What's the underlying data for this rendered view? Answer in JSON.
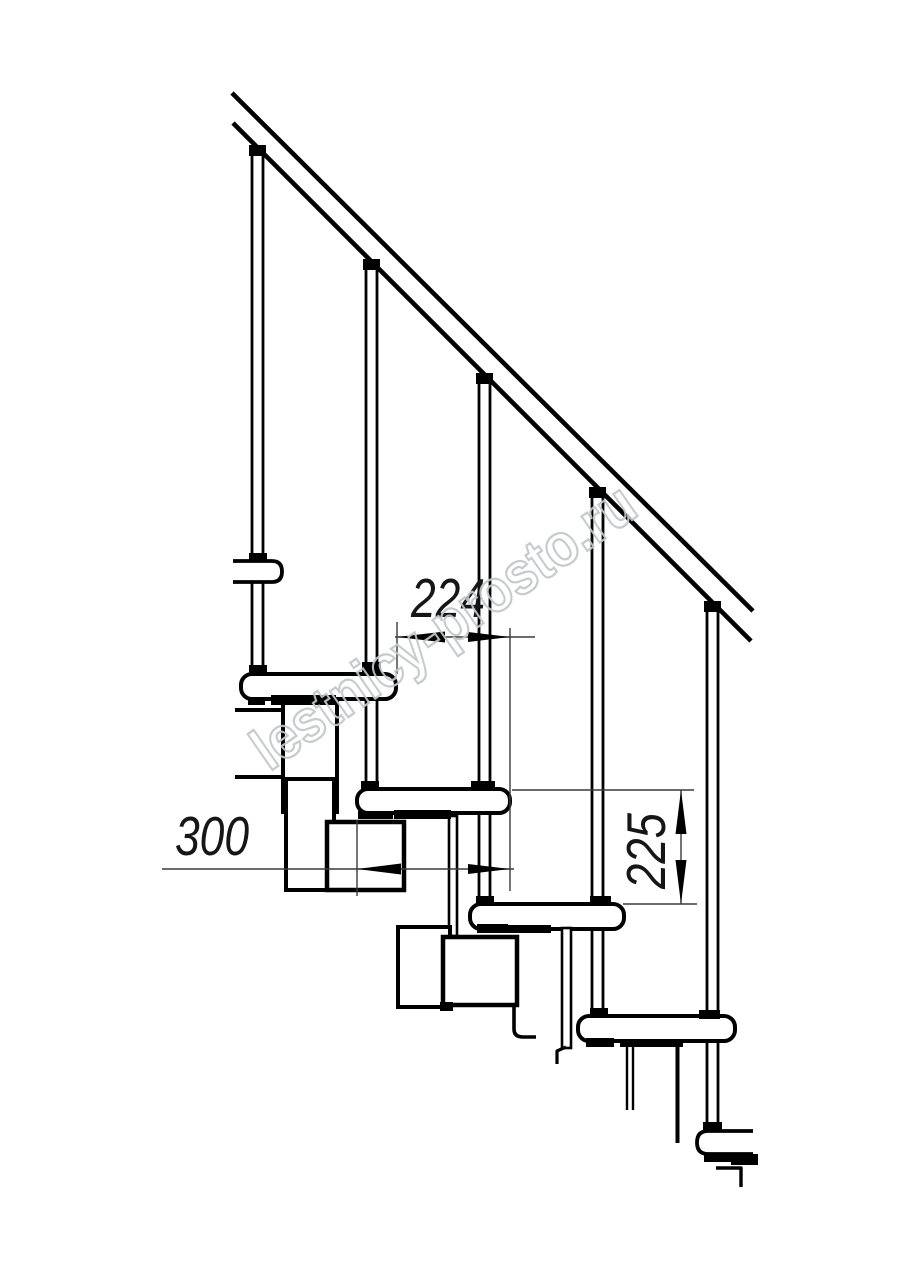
{
  "meta": {
    "canvas_width": 914,
    "canvas_height": 1280,
    "background_color": "#ffffff",
    "ink_color": "#000000",
    "dim_line_color": "#3a3a3a",
    "watermark_color": "#c2c7ca"
  },
  "labels": {
    "dim_run": "224",
    "dim_depth": "300",
    "dim_rise": "225",
    "watermark": "lestnicy-prosto.ru"
  },
  "diagram_data": {
    "type": "technical-drawing",
    "subject": "modular staircase side elevation with balusters and handrail",
    "dimensions_mm": {
      "step_run": 224,
      "tread_depth": 300,
      "step_rise": 225
    },
    "visible_counts": {
      "balusters": 5,
      "full_treads": 4,
      "cut_tread_stubs": 2
    },
    "scale_px_per_mm": 0.5
  },
  "shapes": [
    {
      "name": "baluster-1",
      "type": "baluster",
      "cx": 257.5,
      "y1": 150,
      "y2": 672
    },
    {
      "name": "baluster-2",
      "type": "baluster",
      "cx": 371.5,
      "y1": 264,
      "y2": 788
    },
    {
      "name": "baluster-3",
      "type": "baluster",
      "cx": 484.5,
      "y1": 378,
      "y2": 903
    },
    {
      "name": "baluster-4",
      "type": "baluster",
      "cx": 597.5,
      "y1": 492,
      "y2": 1015
    },
    {
      "name": "baluster-5",
      "type": "baluster",
      "cx": 712.5,
      "y1": 606,
      "y2": 1129
    },
    {
      "name": "handrail-upper-line",
      "type": "line",
      "x1": 232,
      "y1": 93,
      "x2": 753,
      "y2": 611,
      "sw": 4.6
    },
    {
      "name": "handrail-lower-line",
      "type": "line",
      "x1": 233,
      "y1": 123,
      "x2": 751,
      "y2": 641,
      "sw": 4.6
    },
    {
      "name": "rail-tab-1",
      "type": "blackrect",
      "x": 249,
      "y": 145,
      "w": 17,
      "h": 11
    },
    {
      "name": "rail-tab-2",
      "type": "blackrect",
      "x": 363,
      "y": 259,
      "w": 17,
      "h": 11
    },
    {
      "name": "rail-tab-3",
      "type": "blackrect",
      "x": 476,
      "y": 373,
      "w": 17,
      "h": 11
    },
    {
      "name": "rail-tab-4",
      "type": "blackrect",
      "x": 589,
      "y": 487,
      "w": 17,
      "h": 11
    },
    {
      "name": "rail-tab-5",
      "type": "blackrect",
      "x": 704,
      "y": 601,
      "w": 17,
      "h": 11
    },
    {
      "name": "tread-1-stub",
      "type": "path",
      "d": "M233,561 H272 Q282,561 282,571.5 Q282,582 272,582 H233",
      "sw": 3.8,
      "fill": "#ffffff"
    },
    {
      "name": "tread-2",
      "type": "rect",
      "x": 241,
      "y": 674,
      "w": 155,
      "h": 25,
      "rx": 11,
      "sw": 4,
      "fill": "#ffffff"
    },
    {
      "name": "tread-3",
      "type": "rect",
      "x": 357,
      "y": 789,
      "w": 153,
      "h": 24,
      "rx": 11,
      "sw": 4,
      "fill": "#ffffff"
    },
    {
      "name": "tread-4",
      "type": "rect",
      "x": 470,
      "y": 904,
      "w": 154,
      "h": 25,
      "rx": 11,
      "sw": 4,
      "fill": "#ffffff"
    },
    {
      "name": "tread-5",
      "type": "rect",
      "x": 578,
      "y": 1016,
      "w": 157,
      "h": 25,
      "rx": 11,
      "sw": 4,
      "fill": "#ffffff"
    },
    {
      "name": "tread-6-stub",
      "type": "path",
      "d": "M753,1131 H708 Q697,1131 697,1142.5 Q697,1154 708,1154 H753",
      "sw": 3.8,
      "fill": "#ffffff"
    },
    {
      "name": "module-2-wall-bar-top",
      "type": "line",
      "x1": 235,
      "y1": 710,
      "x2": 287,
      "y2": 710,
      "sw": 4
    },
    {
      "name": "module-2-wall-bar-bottom",
      "type": "line",
      "x1": 235,
      "y1": 777,
      "x2": 285,
      "y2": 777,
      "sw": 4
    },
    {
      "name": "module-2-tube-upper",
      "type": "rect",
      "x": 283,
      "y": 700,
      "w": 54,
      "h": 112,
      "rx": 0,
      "sw": 4,
      "fill": "#ffffff"
    },
    {
      "name": "module-2-tube-lower",
      "type": "rect",
      "x": 286,
      "y": 779,
      "w": 48,
      "h": 111,
      "rx": 0,
      "sw": 4,
      "fill": "#ffffff"
    },
    {
      "name": "module-3-box",
      "type": "rect",
      "x": 327,
      "y": 822,
      "w": 77,
      "h": 68,
      "rx": 0,
      "sw": 4.5,
      "fill": "#ffffff"
    },
    {
      "name": "module-3-hanger-plate",
      "type": "rect",
      "x": 449,
      "y": 816,
      "w": 8,
      "h": 120,
      "rx": 0,
      "sw": 2.6,
      "fill": "#ffffff"
    },
    {
      "name": "module-4-tube",
      "type": "rect",
      "x": 398,
      "y": 927,
      "w": 52,
      "h": 80,
      "rx": 0,
      "sw": 4,
      "fill": "#ffffff"
    },
    {
      "name": "module-4-box",
      "type": "rect",
      "x": 443,
      "y": 937,
      "w": 74,
      "h": 68,
      "rx": 0,
      "sw": 4.5,
      "fill": "#ffffff"
    },
    {
      "name": "module-4-foot",
      "type": "blackrect",
      "x": 440,
      "y": 1002,
      "w": 13,
      "h": 9
    },
    {
      "name": "module-4-hook",
      "type": "path",
      "d": "M514,1004 L514,1029 Q514,1037 523,1037 L536,1037",
      "sw": 3.6,
      "fill": "none"
    },
    {
      "name": "module-5-hanger-plate",
      "type": "rect",
      "x": 562,
      "y": 928,
      "w": 9,
      "h": 120,
      "rx": 0,
      "sw": 2.6,
      "fill": "#ffffff"
    },
    {
      "name": "module-5-hanger-hook",
      "type": "path",
      "d": "M566,1047 L557,1051 L557,1064",
      "sw": 3.2,
      "fill": "none"
    },
    {
      "name": "module-5-plate-left-edge",
      "type": "line",
      "x1": 627,
      "y1": 1043,
      "x2": 627,
      "y2": 1110,
      "sw": 2.4
    },
    {
      "name": "module-5-plate-right-edge",
      "type": "line",
      "x1": 633,
      "y1": 1043,
      "x2": 633,
      "y2": 1110,
      "sw": 2.4
    },
    {
      "name": "module-5-drop-line",
      "type": "line",
      "x1": 677.5,
      "y1": 1043,
      "x2": 677.5,
      "y2": 1143,
      "sw": 4
    },
    {
      "name": "module-6-hook",
      "type": "path",
      "d": "M716,1168 L741,1168 L741,1187",
      "sw": 3.4,
      "fill": "none"
    },
    {
      "name": "joint-b1-stub",
      "type": "blackrect",
      "x": 249,
      "y": 553,
      "w": 18,
      "h": 8
    },
    {
      "name": "joint-b1-tread2",
      "type": "blackrect",
      "x": 249,
      "y": 665,
      "w": 18,
      "h": 9
    },
    {
      "name": "collar-b2-tread2",
      "type": "blackrect",
      "x": 362,
      "y": 662,
      "w": 19,
      "h": 10
    },
    {
      "name": "nub-b1-under-tread2",
      "type": "blackrect",
      "x": 248,
      "y": 697,
      "w": 17,
      "h": 8
    },
    {
      "name": "weld-band-tread2",
      "type": "blackrect",
      "x": 271,
      "y": 695,
      "w": 65,
      "h": 10
    },
    {
      "name": "joint-b2-tread3",
      "type": "blackrect",
      "x": 361,
      "y": 781,
      "w": 18,
      "h": 9
    },
    {
      "name": "collar-b3-tread3",
      "type": "blackrect",
      "x": 471,
      "y": 781,
      "w": 24,
      "h": 10
    },
    {
      "name": "nub-b2-under-tread3",
      "type": "blackrect",
      "x": 358,
      "y": 811,
      "w": 35,
      "h": 8
    },
    {
      "name": "weld-band-tread3",
      "type": "blackrect",
      "x": 394,
      "y": 810,
      "w": 57,
      "h": 9
    },
    {
      "name": "joint-b3-tread4",
      "type": "blackrect",
      "x": 476,
      "y": 896,
      "w": 18,
      "h": 9
    },
    {
      "name": "collar-b4-tread4",
      "type": "blackrect",
      "x": 590,
      "y": 896,
      "w": 21,
      "h": 10
    },
    {
      "name": "nub-b3-under-tread4",
      "type": "blackrect",
      "x": 477,
      "y": 924,
      "w": 31,
      "h": 9
    },
    {
      "name": "weld-band-tread4",
      "type": "blackrect",
      "x": 506,
      "y": 925,
      "w": 45,
      "h": 8
    },
    {
      "name": "joint-b4-tread5",
      "type": "blackrect",
      "x": 590,
      "y": 1008,
      "w": 18,
      "h": 9
    },
    {
      "name": "collar-b5-tread5",
      "type": "blackrect",
      "x": 699,
      "y": 1010,
      "w": 21,
      "h": 9
    },
    {
      "name": "nub-b4-under-tread5",
      "type": "blackrect",
      "x": 586,
      "y": 1038,
      "w": 28,
      "h": 9
    },
    {
      "name": "weld-band-tread5",
      "type": "blackrect",
      "x": 620,
      "y": 1039,
      "w": 63,
      "h": 8
    },
    {
      "name": "joint-b5-tread6",
      "type": "blackrect",
      "x": 703,
      "y": 1122,
      "w": 19,
      "h": 9
    },
    {
      "name": "nub-under-tread6",
      "type": "blackrect",
      "x": 704,
      "y": 1154,
      "w": 34,
      "h": 8
    },
    {
      "name": "block-under-tread6",
      "type": "blackrect",
      "x": 731,
      "y": 1154,
      "w": 27,
      "h": 11
    },
    {
      "name": "ext-line-run-left",
      "type": "dimline",
      "x1": 397,
      "y1": 622,
      "x2": 397,
      "y2": 674
    },
    {
      "name": "ext-line-shared-right",
      "type": "dimline",
      "x1": 510,
      "y1": 628,
      "x2": 510,
      "y2": 891
    },
    {
      "name": "dim-line-run",
      "type": "dimline",
      "x1": 395,
      "y1": 637,
      "x2": 535,
      "y2": 637
    },
    {
      "name": "arrow-run-left",
      "type": "poly",
      "points": "397,637 445,631.5 445,642.5"
    },
    {
      "name": "arrow-run-right",
      "type": "poly",
      "points": "510,637 468,632 468,642"
    },
    {
      "name": "ext-line-depth-left",
      "type": "dimline",
      "x1": 357,
      "y1": 820,
      "x2": 357,
      "y2": 896
    },
    {
      "name": "dim-line-depth",
      "type": "dimline",
      "x1": 162,
      "y1": 869,
      "x2": 514,
      "y2": 869
    },
    {
      "name": "arrow-depth-left",
      "type": "poly",
      "points": "357,869 401,863.5 401,874.5"
    },
    {
      "name": "arrow-depth-right",
      "type": "poly",
      "points": "510,869 468,864 468,874"
    },
    {
      "name": "ext-line-rise-top",
      "type": "dimline",
      "x1": 512,
      "y1": 790,
      "x2": 694,
      "y2": 790
    },
    {
      "name": "ext-line-rise-bottom",
      "type": "dimline",
      "x1": 623,
      "y1": 904,
      "x2": 697,
      "y2": 904
    },
    {
      "name": "dim-line-rise",
      "type": "dimline",
      "x1": 681,
      "y1": 790,
      "x2": 681,
      "y2": 904
    },
    {
      "name": "arrow-rise-up",
      "type": "poly",
      "points": "681,790 675.5,834 686.5,834"
    },
    {
      "name": "arrow-rise-down",
      "type": "poly",
      "points": "681,904 675.5,860 686.5,860"
    }
  ],
  "texts": [
    {
      "name": "dim-run-label",
      "label_key": "dim_run",
      "x": 448,
      "y": 617,
      "fs": 55,
      "text_length": 74,
      "rotate": 0
    },
    {
      "name": "dim-depth-label",
      "label_key": "dim_depth",
      "x": 212,
      "y": 855,
      "fs": 55,
      "text_length": 74,
      "rotate": 0
    },
    {
      "name": "dim-rise-label",
      "label_key": "dim_rise",
      "x": 665,
      "y": 851,
      "fs": 55,
      "text_length": 76,
      "rotate": -90
    },
    {
      "name": "watermark-text",
      "label_key": "watermark",
      "x": 455,
      "y": 643,
      "fs": 60,
      "text_length": 452,
      "rotate": -34.8,
      "watermark": true
    }
  ]
}
